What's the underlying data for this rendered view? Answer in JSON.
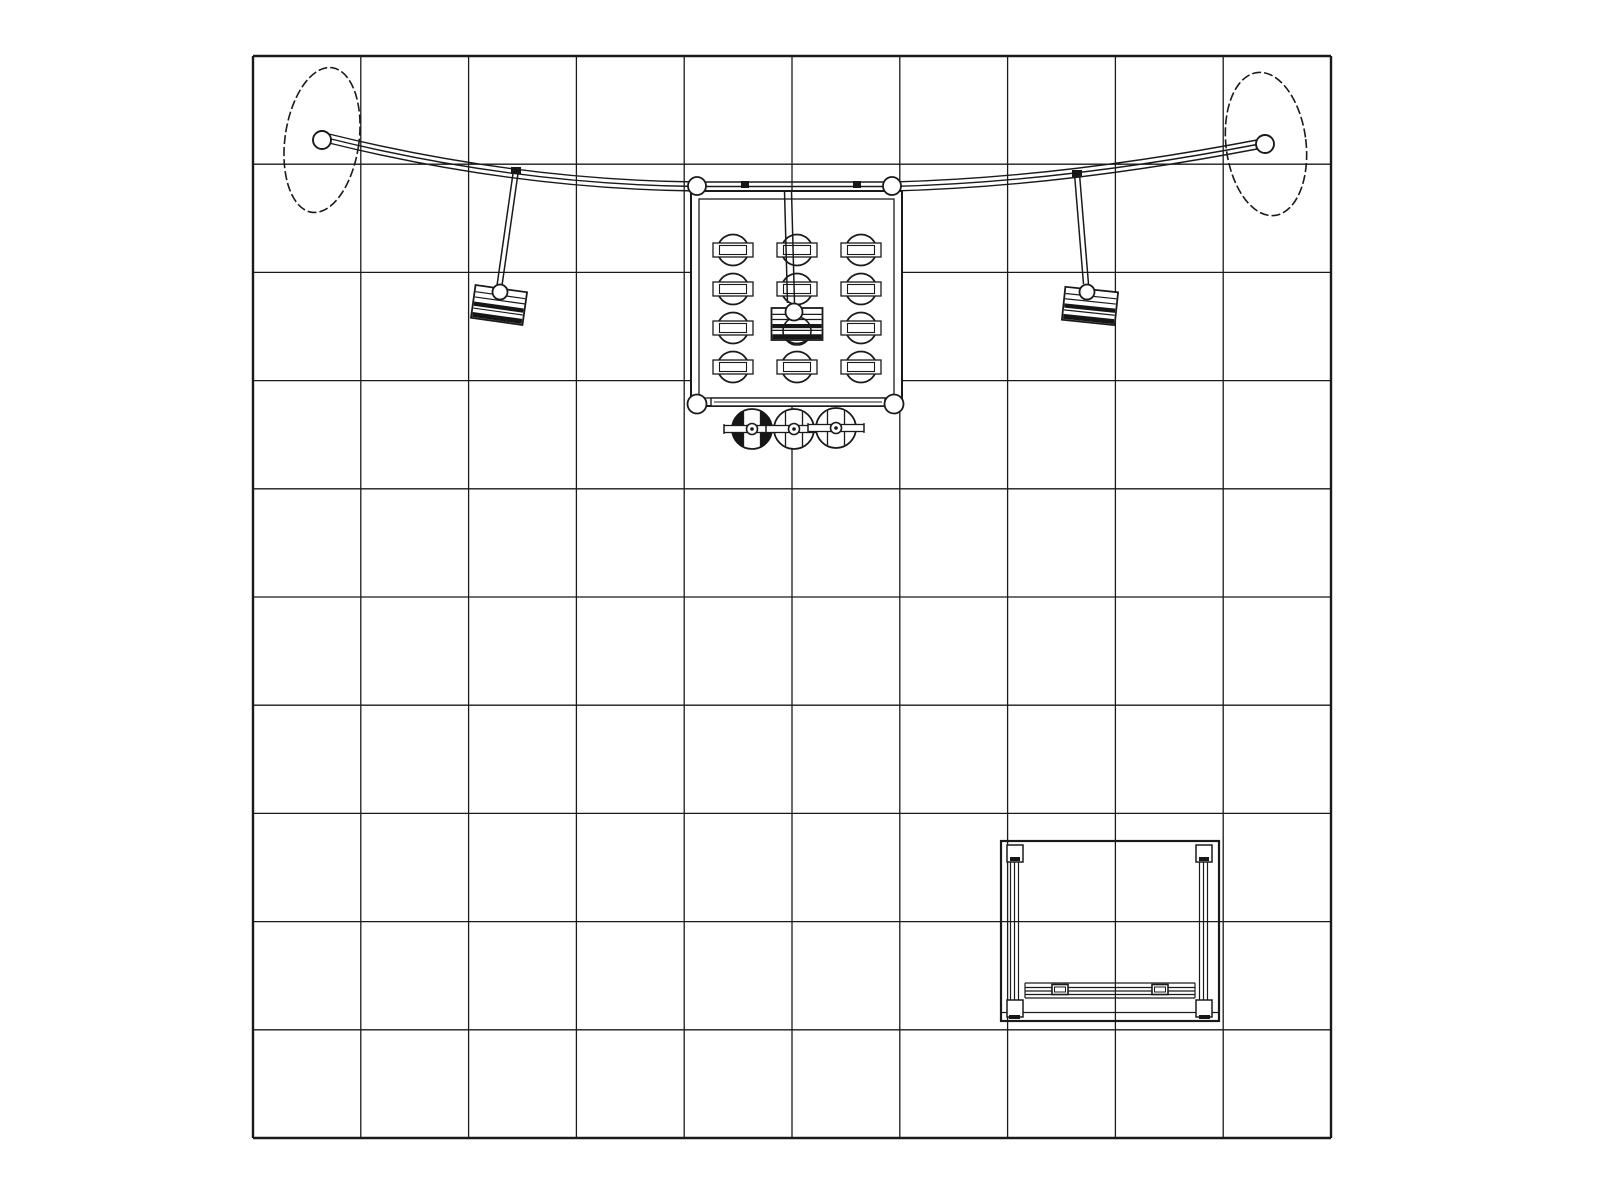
{
  "meta": {
    "background": "#ffffff",
    "line_color": "#1a1a1a",
    "dark_fill": "#161616",
    "canvas_width": 1600,
    "canvas_height": 1200
  },
  "grid": {
    "x": 253,
    "y": 56,
    "width": 1078,
    "height": 1082,
    "cols": 10,
    "rows": 10,
    "inner_stroke": 1.3,
    "border_stroke": 2.4
  },
  "discs": [
    {
      "name": "left-disc",
      "cx": 322,
      "cy": 140,
      "rx": 37,
      "ry": 73,
      "rot": 8,
      "stroke": 1.6,
      "dash": "9 3"
    },
    {
      "name": "right-disc",
      "cx": 1266,
      "cy": 144,
      "rx": 40,
      "ry": 72,
      "rot": -7,
      "stroke": 1.6,
      "dash": "9 3"
    }
  ],
  "beam": {
    "start": [
      329,
      134
    ],
    "c1": [
      515,
      180
    ],
    "m1": [
      697,
      182
    ],
    "m2": [
      892,
      182
    ],
    "c2": [
      1058,
      178
    ],
    "end": [
      1257,
      140
    ],
    "offsets": [
      0,
      4.5,
      9
    ],
    "stroke": 1.4,
    "clamps": [
      [
        741,
        181,
        8,
        7
      ],
      [
        853,
        181,
        8,
        7
      ],
      [
        511,
        167,
        10,
        7
      ],
      [
        1072,
        170,
        10,
        7
      ]
    ],
    "junction_hubs": [
      {
        "cx": 697,
        "cy": 186,
        "r": 9
      },
      {
        "cx": 892,
        "cy": 186,
        "r": 9
      }
    ],
    "disc_hubs": [
      {
        "cx": 322,
        "cy": 140,
        "r": 9
      },
      {
        "cx": 1265,
        "cy": 144,
        "r": 9
      }
    ]
  },
  "frame": {
    "outer": [
      691,
      191,
      211,
      215
    ],
    "inner": [
      699,
      199,
      195,
      199
    ],
    "outer_stroke": 2.0,
    "inner_stroke": 1.3,
    "bottom_hubs": [
      {
        "cx": 697,
        "cy": 404,
        "r": 9.5
      },
      {
        "cx": 894,
        "cy": 404,
        "r": 9.5
      }
    ],
    "shelf": {
      "rect": [
        711,
        398,
        174,
        8
      ],
      "inner_y": 402,
      "stroke": 1.4
    }
  },
  "spotlights": {
    "cols": [
      733,
      797,
      861
    ],
    "rows": [
      250,
      289,
      328,
      367
    ],
    "r": 15.5,
    "band_outer": [
      40,
      14
    ],
    "band_inner": [
      27,
      9
    ],
    "circle_stroke": 1.8,
    "band_stroke": 1.3
  },
  "arms": [
    {
      "name": "left-light-arm",
      "x1": 516,
      "y1": 170,
      "x2": 499,
      "y2": 289,
      "gap": 5,
      "stroke": 1.5,
      "hub": {
        "cx": 500,
        "cy": 292,
        "r": 7.5
      }
    },
    {
      "name": "right-light-arm",
      "x1": 1077,
      "y1": 174,
      "x2": 1086,
      "y2": 284,
      "gap": 5,
      "stroke": 1.5,
      "hub": {
        "cx": 1087,
        "cy": 292,
        "r": 7.5
      }
    },
    {
      "name": "center-light-arm",
      "x1": 788,
      "y1": 191,
      "x2": 791,
      "y2": 303,
      "gap": 7,
      "stroke": 1.5,
      "hub": {
        "cx": 794,
        "cy": 312,
        "r": 8.5
      }
    }
  ],
  "fixtures": [
    {
      "name": "hanging-light-left",
      "cx": 499,
      "cy": 305,
      "w": 52,
      "h": 33,
      "rot": 8
    },
    {
      "name": "hanging-light-right",
      "cx": 1090,
      "cy": 306,
      "w": 53,
      "h": 33,
      "rot": 6
    },
    {
      "name": "hanging-light-center",
      "cx": 797,
      "cy": 324,
      "w": 51,
      "h": 32,
      "rot": 0,
      "can": {
        "cx": 797,
        "cy": 331,
        "r": 14
      }
    }
  ],
  "fixture_style": {
    "stroke": 1.8,
    "stripe_lines": [
      0.2,
      0.36,
      0.7
    ],
    "stripe_bands": [
      [
        0.5,
        0.63
      ],
      [
        0.82,
        0.97
      ]
    ]
  },
  "stools": [
    {
      "cx": 752,
      "cy": 429,
      "r": 20,
      "dark": true
    },
    {
      "cx": 794,
      "cy": 429,
      "r": 20,
      "dark": false
    },
    {
      "cx": 836,
      "cy": 428,
      "r": 20,
      "dark": false
    }
  ],
  "stool_style": {
    "chord_dx": 8.5,
    "axle_half": 28,
    "axle_h": 7,
    "hub_r": 5.5,
    "dot_r": 1.8,
    "stroke": 1.8
  },
  "counter": {
    "outer": [
      1001,
      841,
      218,
      180
    ],
    "outer_stroke": 2.2,
    "bottom_lines": [
      1012.5
    ],
    "posts": [
      {
        "caps": [
          [
            1007,
            845,
            16,
            17
          ],
          [
            1007,
            1000,
            16,
            17
          ]
        ],
        "lines_x": [
          1010.5,
          1014.5,
          1018.5
        ],
        "y1": 862,
        "y2": 1000,
        "ticks": [
          [
            1010,
            857,
            10,
            4
          ],
          [
            1009,
            1015,
            11,
            4
          ]
        ]
      },
      {
        "caps": [
          [
            1196,
            845,
            16,
            17
          ],
          [
            1196,
            1000,
            16,
            17
          ]
        ],
        "lines_x": [
          1199.5,
          1203.5,
          1207.5
        ],
        "y1": 862,
        "y2": 1000,
        "ticks": [
          [
            1199,
            857,
            10,
            4
          ],
          [
            1199,
            1015,
            11,
            4
          ]
        ]
      }
    ],
    "rail": {
      "x1": 1025,
      "x2": 1195,
      "lines_y": [
        983,
        987.5,
        991,
        994.5,
        998
      ],
      "tabs": [
        [
          1052,
          984.5,
          16,
          10
        ],
        [
          1152,
          984.5,
          16,
          10
        ]
      ]
    }
  }
}
